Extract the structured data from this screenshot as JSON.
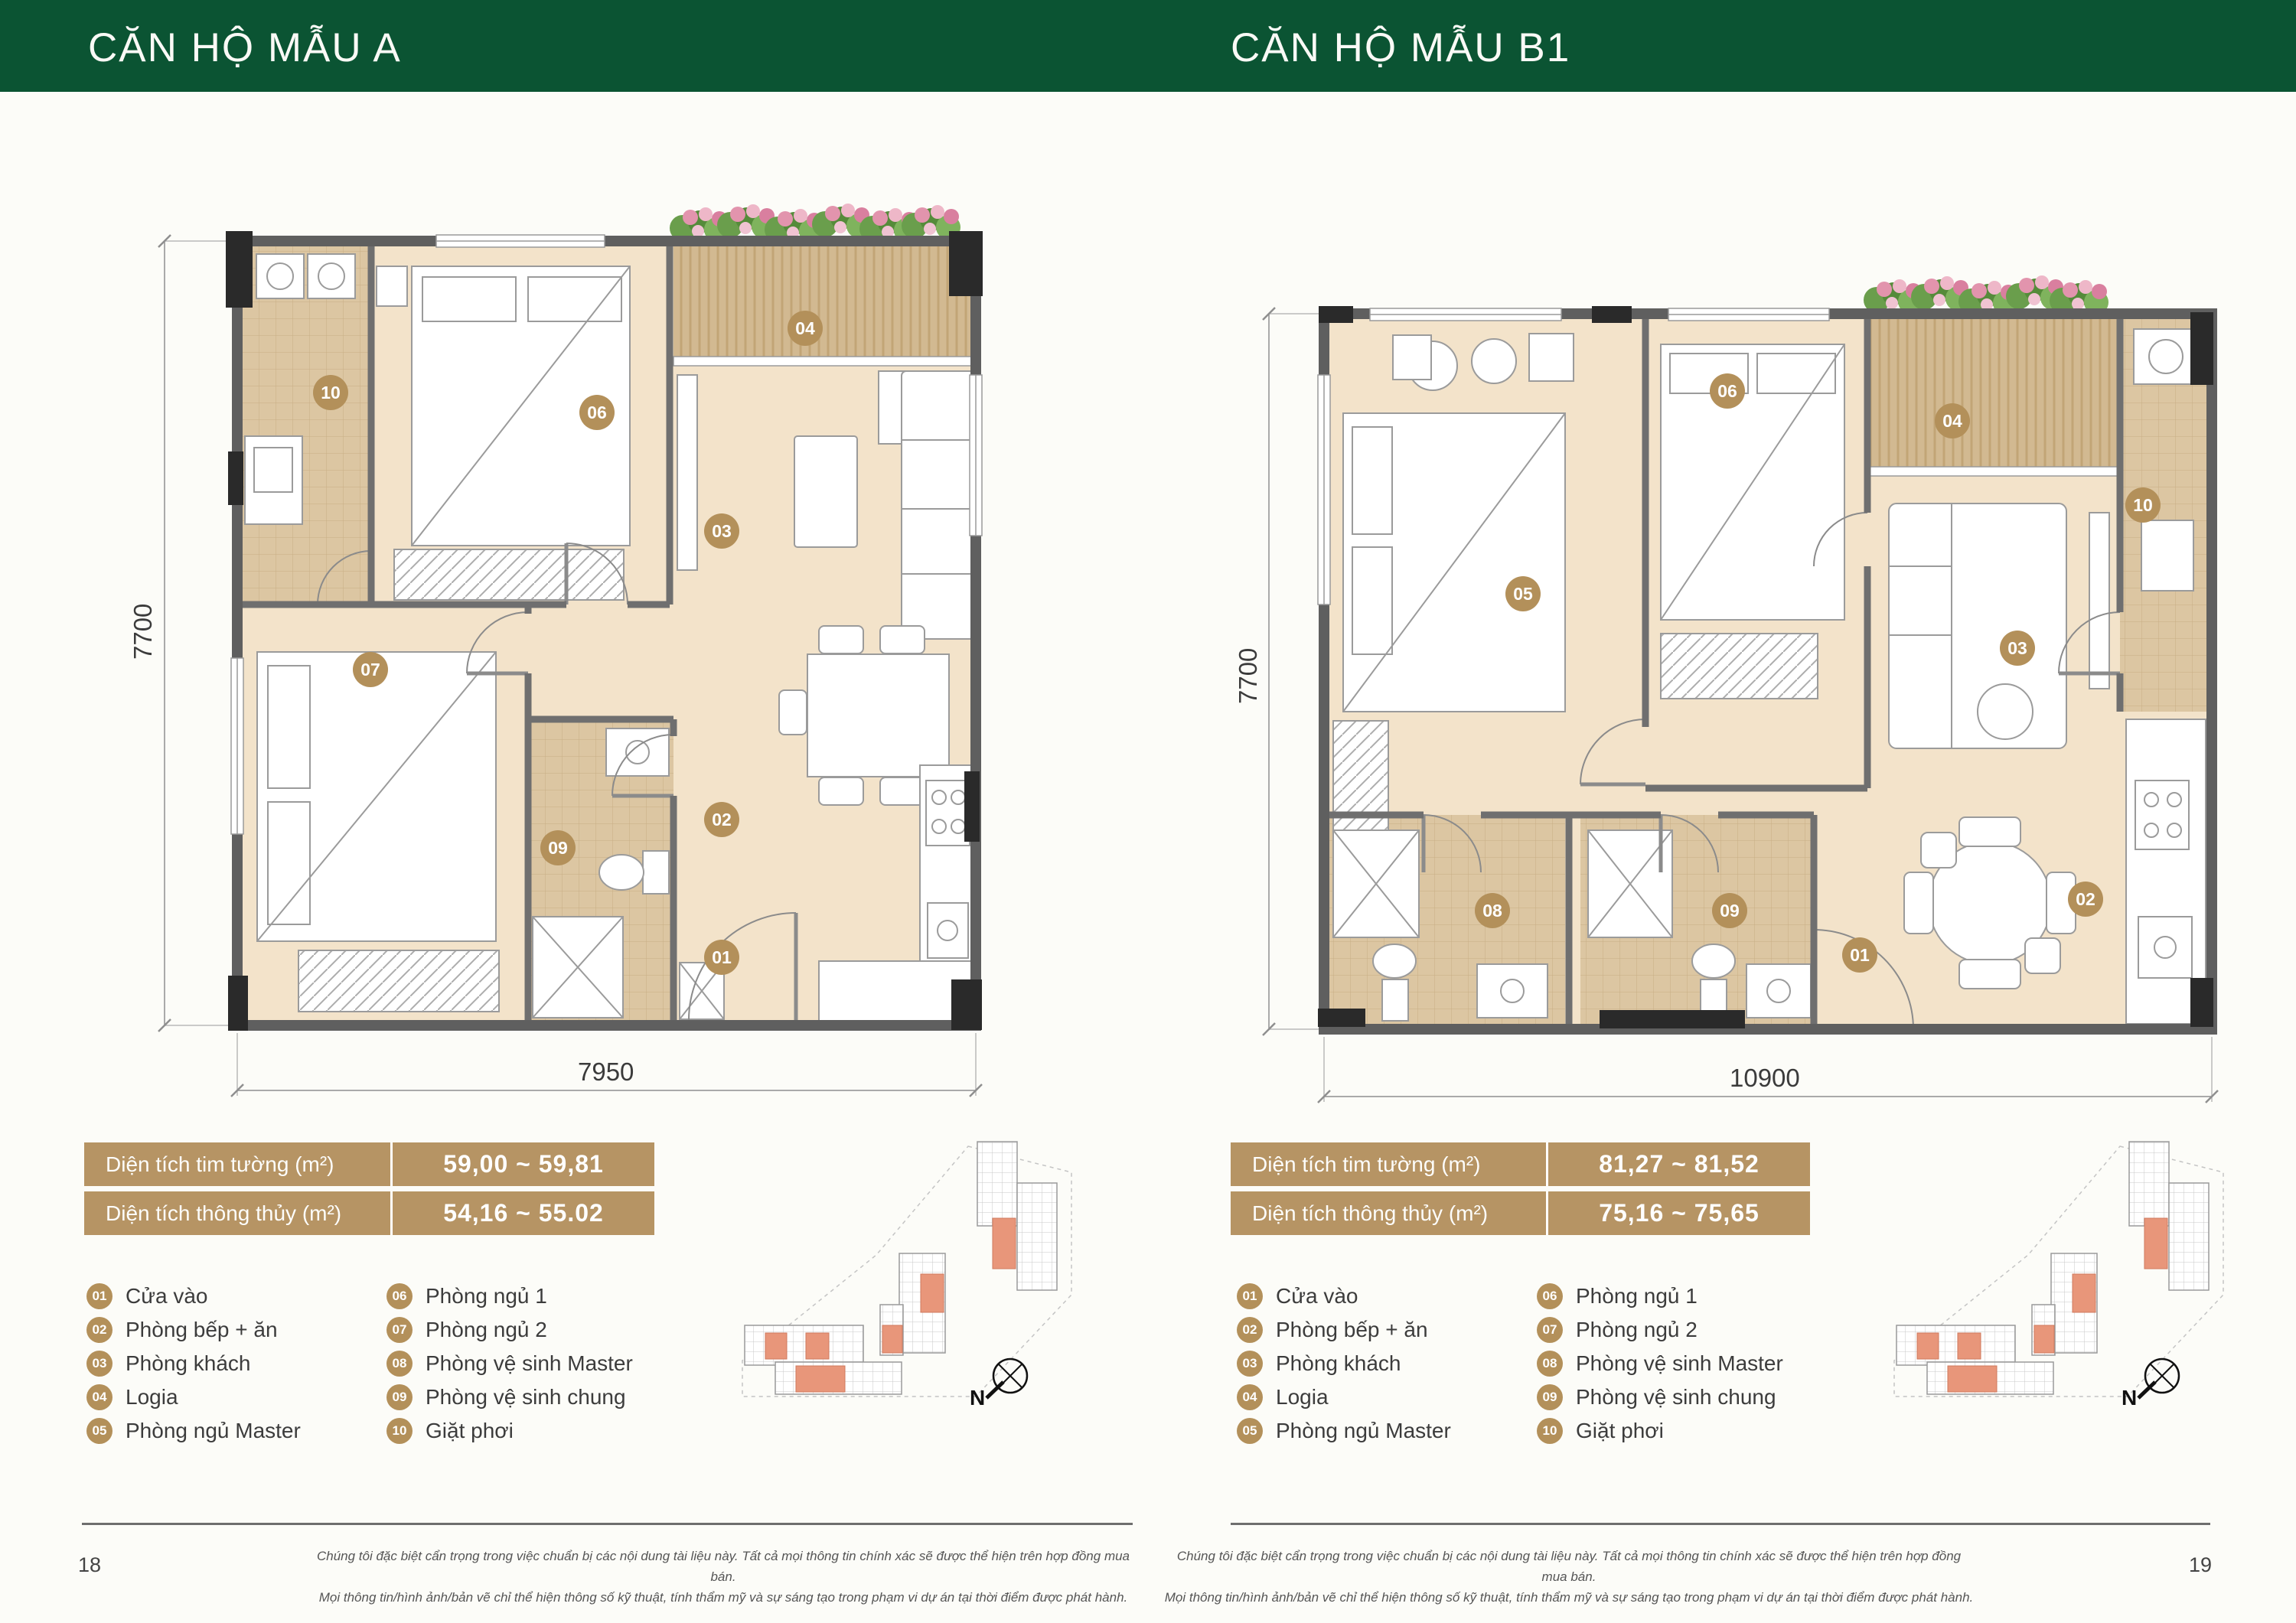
{
  "header": {
    "left_title": "CĂN HỘ MẪU A",
    "right_title": "CĂN HỘ MẪU B1",
    "bar_color": "#0b5433"
  },
  "pages": {
    "left": {
      "number": "18",
      "plan": {
        "name": "A",
        "dim_height": "7700",
        "dim_width": "7950",
        "markers": [
          "10",
          "06",
          "04",
          "03",
          "07",
          "09",
          "02",
          "01"
        ]
      },
      "area_table": {
        "rows": [
          {
            "label": "Diện tích tim tường (m²)",
            "value": "59,00 ~ 59,81"
          },
          {
            "label": "Diện tích thông thủy (m²)",
            "value": "54,16 ~ 55.02"
          }
        ]
      }
    },
    "right": {
      "number": "19",
      "plan": {
        "name": "B1",
        "dim_height": "7700",
        "dim_width": "10900",
        "markers": [
          "06",
          "04",
          "10",
          "05",
          "03",
          "08",
          "09",
          "02",
          "01"
        ]
      },
      "area_table": {
        "rows": [
          {
            "label": "Diện tích tim tường (m²)",
            "value": "81,27 ~ 81,52"
          },
          {
            "label": "Diện tích thông thủy (m²)",
            "value": "75,16 ~ 75,65"
          }
        ]
      }
    }
  },
  "legend": {
    "items": [
      {
        "num": "01",
        "label": "Cửa vào"
      },
      {
        "num": "02",
        "label": "Phòng bếp + ăn"
      },
      {
        "num": "03",
        "label": "Phòng khách"
      },
      {
        "num": "04",
        "label": "Logia"
      },
      {
        "num": "05",
        "label": "Phòng ngủ Master"
      },
      {
        "num": "06",
        "label": "Phòng ngủ 1"
      },
      {
        "num": "07",
        "label": "Phòng ngủ 2"
      },
      {
        "num": "08",
        "label": "Phòng vệ sinh Master"
      },
      {
        "num": "09",
        "label": "Phòng vệ sinh chung"
      },
      {
        "num": "10",
        "label": "Giặt phơi"
      }
    ]
  },
  "compass": {
    "label": "N"
  },
  "footer": {
    "line1": "Chúng tôi đặc biệt cẩn trọng trong việc chuẩn bị các nội dung tài liệu này. Tất cả mọi thông tin chính xác sẽ được thể hiện trên hợp đồng mua bán.",
    "line2": "Mọi thông tin/hình ảnh/bản vẽ chỉ thể hiện thông số kỹ thuật, tính thẩm mỹ và sự sáng tạo trong phạm vi dự án tại thời điểm được phát hành."
  },
  "colors": {
    "green": "#0b5433",
    "tan_table": "#b69464",
    "tan_badge": "#b3905a",
    "floor": "#f3e3ca",
    "tile": "#dcc6a2",
    "wall": "#5f5f5f",
    "keyplan_highlight": "#e8967a"
  }
}
